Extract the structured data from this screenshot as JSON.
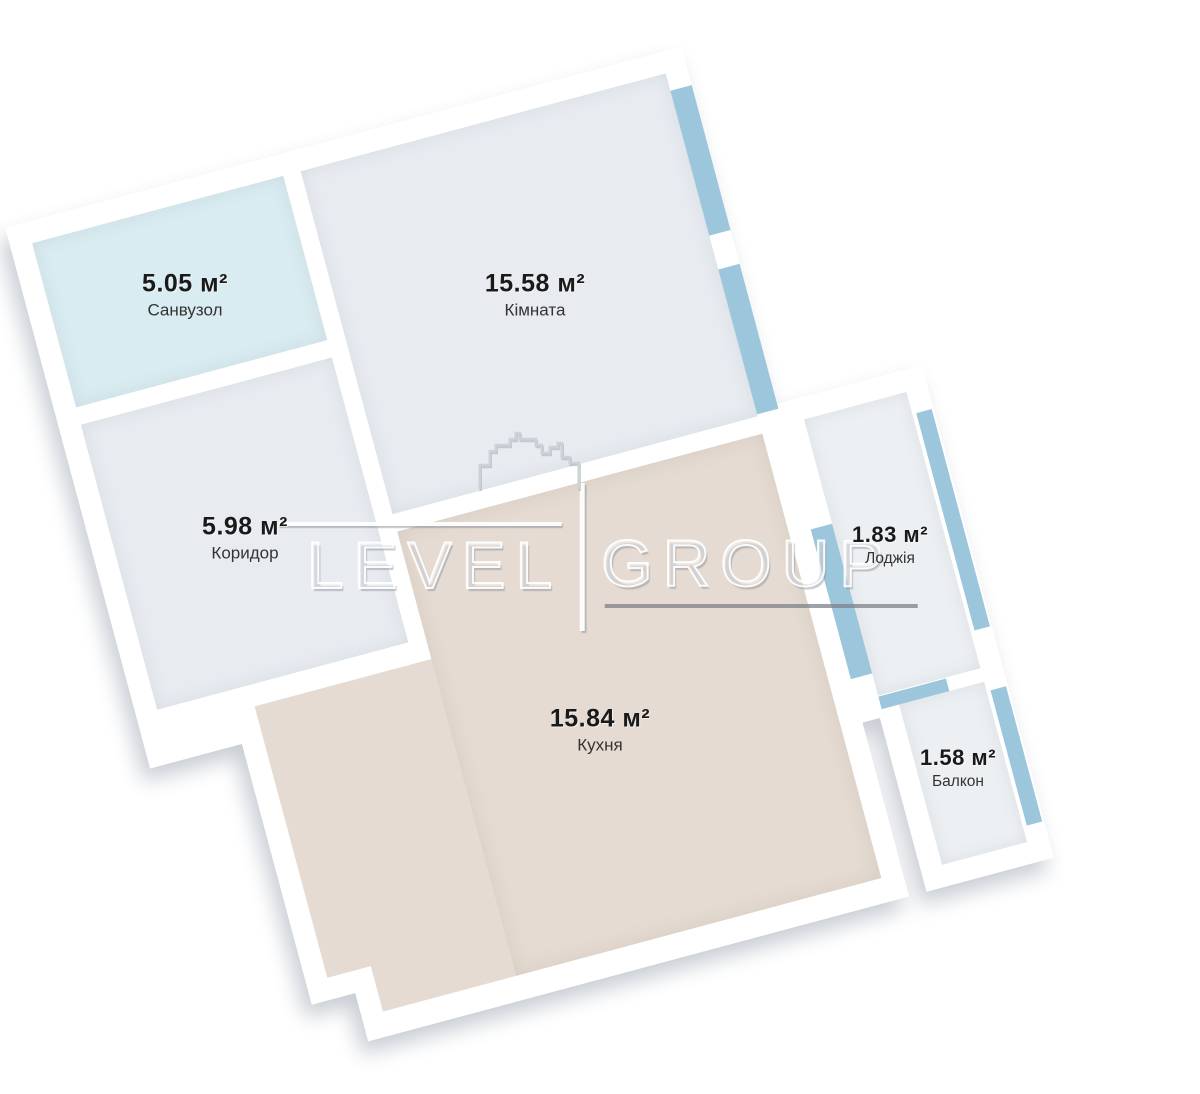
{
  "plan": {
    "title": "1-room apartment floor plan",
    "rotation_deg": -15,
    "rooms": [
      {
        "name": "Санвузол",
        "area": "5.05 м²"
      },
      {
        "name": "Кімната",
        "area": "15.58 м²"
      },
      {
        "name": "Коридор",
        "area": "5.98 м²"
      },
      {
        "name": "Кухня",
        "area": "15.84 м²"
      },
      {
        "name": "Лоджія",
        "area": "1.83 м²"
      },
      {
        "name": "Балкон",
        "area": "1.58 м²"
      }
    ],
    "watermark": {
      "brand_left": "LEVEL",
      "brand_right": "GROUP",
      "icon": "building-skyline-outline"
    }
  },
  "colors": {
    "background": "#ffffff",
    "wall": "#ffffff",
    "window_glazing": "#9cc6db",
    "floor_bathroom": "#d9ecf1",
    "floor_room": "#e8ecf1",
    "floor_corridor": "#e8ecf1",
    "floor_kitchen": "#e5dbd2",
    "floor_loggia": "#edf0f3",
    "floor_balcony": "#edf0f3",
    "area_text": "#1a1a1a",
    "name_text": "#333333"
  }
}
